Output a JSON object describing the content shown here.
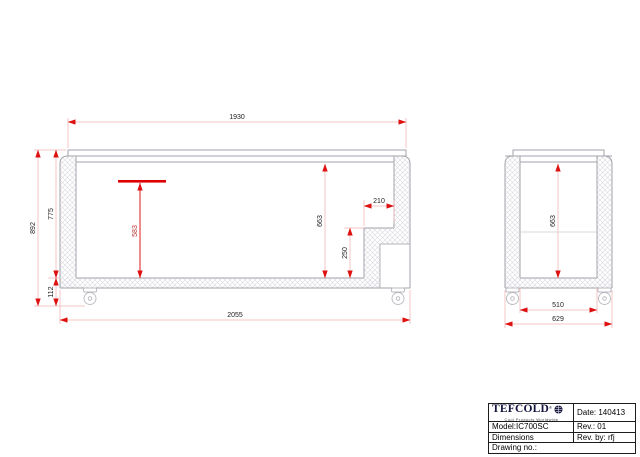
{
  "views": {
    "front": {
      "label": "front-section-view",
      "dims": {
        "lid_width": "1930",
        "overall_length": "2055",
        "overall_height": "892",
        "body_height": "775",
        "caster_height": "112",
        "interior_depth": "663",
        "load_line_depth": "583",
        "step_height": "250",
        "step_width": "210"
      }
    },
    "side": {
      "label": "side-section-view",
      "dims": {
        "interior_depth": "663",
        "interior_width": "510",
        "overall_width": "629"
      }
    }
  },
  "title_block": {
    "brand": "TEFCOLD",
    "reg_mark": "®",
    "tagline": "Cool Products Worldwide",
    "date": "Date: 140413",
    "model": "Model:IC700SC",
    "rev": "Rev.: 01",
    "dimensions": "Dimensions",
    "rev_by": "Rev. by: rfj",
    "drawing_no": "Drawing no.:"
  },
  "colors": {
    "body_line_gray": "#a3a3ab",
    "hatch_gray": "#d8d8e0",
    "dim_line_pink": "#f0b3b3",
    "dim_arrow_red": "#dd1111",
    "dim_text": "#222222",
    "accent_red": "#dd0000",
    "logo_navy": "#14143c"
  }
}
